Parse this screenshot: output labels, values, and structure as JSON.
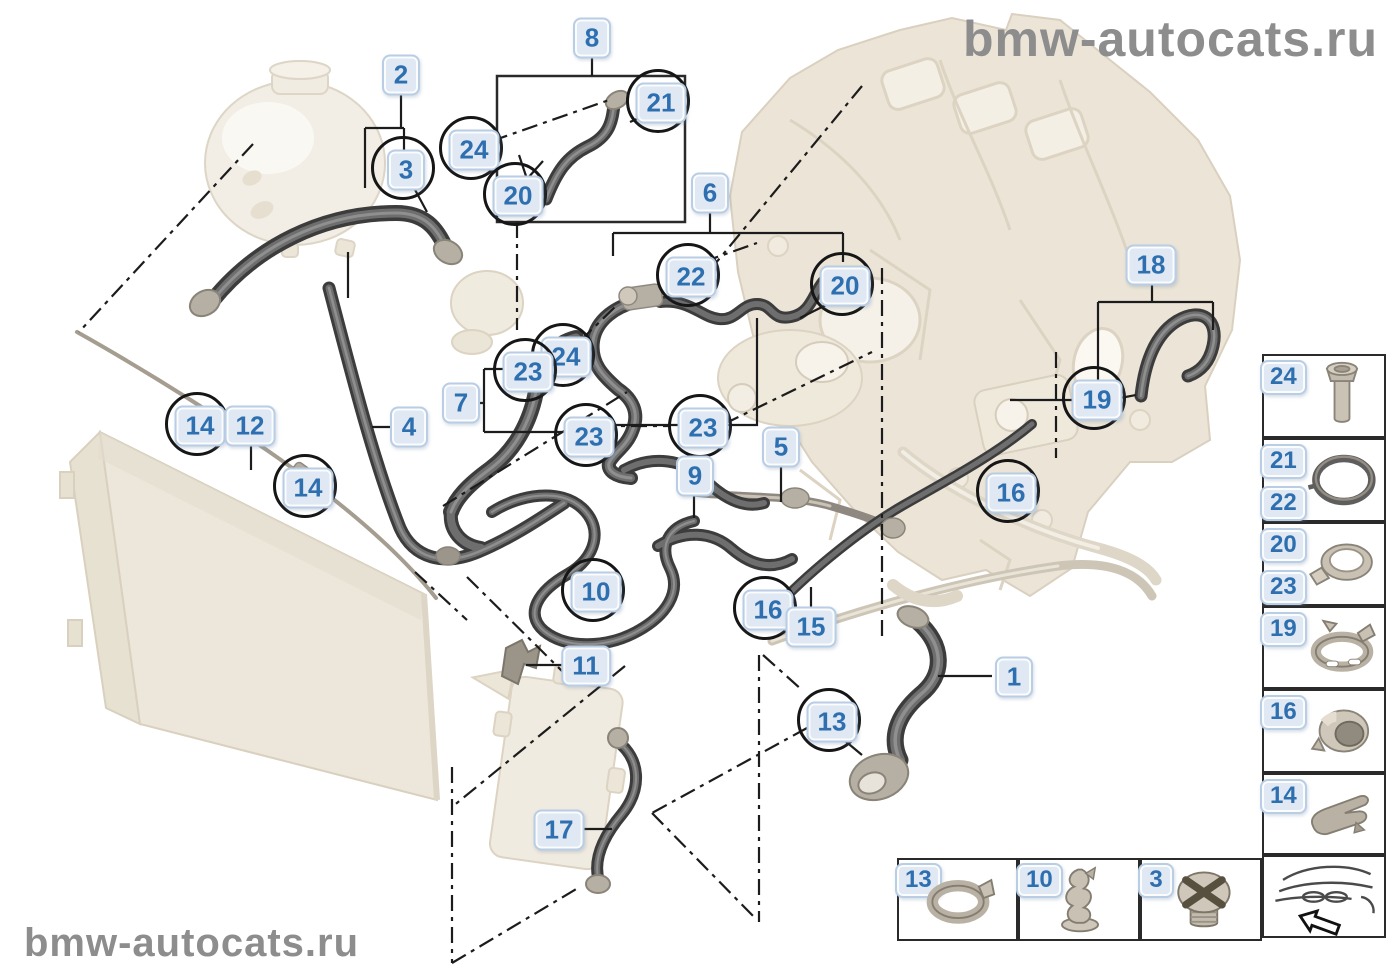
{
  "watermark": {
    "top_right": "bmw-autocats.ru",
    "bottom_left": "bmw-autocats.ru"
  },
  "colors": {
    "callout_text": "#2e6fb0",
    "callout_bg": "#dfe8f3",
    "callout_border": "#b9cde4",
    "circle_outline": "#161616",
    "hose_dark": "#3c3c3c",
    "part_pale": "#ece5d7",
    "watermark_gray": "#8d8d8d",
    "line_black": "#1c1c1c"
  },
  "callouts": [
    {
      "label": "2",
      "x": 401,
      "y": 75,
      "circled": false
    },
    {
      "label": "8",
      "x": 592,
      "y": 38,
      "circled": false
    },
    {
      "label": "21",
      "x": 661,
      "y": 103,
      "circled": true
    },
    {
      "label": "24",
      "x": 474,
      "y": 150,
      "circled": true
    },
    {
      "label": "3",
      "x": 406,
      "y": 170,
      "circled": true
    },
    {
      "label": "20",
      "x": 518,
      "y": 196,
      "circled": true
    },
    {
      "label": "6",
      "x": 710,
      "y": 193,
      "circled": false
    },
    {
      "label": "22",
      "x": 691,
      "y": 277,
      "circled": true
    },
    {
      "label": "20",
      "x": 845,
      "y": 286,
      "circled": true
    },
    {
      "label": "18",
      "x": 1151,
      "y": 265,
      "circled": false
    },
    {
      "label": "24",
      "x": 566,
      "y": 357,
      "circled": true
    },
    {
      "label": "23",
      "x": 528,
      "y": 372,
      "circled": true
    },
    {
      "label": "7",
      "x": 461,
      "y": 403,
      "circled": false
    },
    {
      "label": "23",
      "x": 589,
      "y": 437,
      "circled": true
    },
    {
      "label": "23",
      "x": 703,
      "y": 428,
      "circled": true
    },
    {
      "label": "19",
      "x": 1097,
      "y": 400,
      "circled": true
    },
    {
      "label": "14",
      "x": 200,
      "y": 426,
      "circled": true
    },
    {
      "label": "12",
      "x": 250,
      "y": 426,
      "circled": false
    },
    {
      "label": "4",
      "x": 409,
      "y": 427,
      "circled": false
    },
    {
      "label": "5",
      "x": 781,
      "y": 447,
      "circled": false
    },
    {
      "label": "9",
      "x": 695,
      "y": 476,
      "circled": false
    },
    {
      "label": "14",
      "x": 308,
      "y": 488,
      "circled": true
    },
    {
      "label": "16",
      "x": 1011,
      "y": 493,
      "circled": true
    },
    {
      "label": "10",
      "x": 596,
      "y": 592,
      "circled": true
    },
    {
      "label": "16",
      "x": 768,
      "y": 610,
      "circled": true
    },
    {
      "label": "15",
      "x": 811,
      "y": 627,
      "circled": false
    },
    {
      "label": "11",
      "x": 586,
      "y": 666,
      "circled": false
    },
    {
      "label": "1",
      "x": 1014,
      "y": 677,
      "circled": false
    },
    {
      "label": "13",
      "x": 832,
      "y": 722,
      "circled": true
    },
    {
      "label": "17",
      "x": 559,
      "y": 830,
      "circled": false
    }
  ],
  "sidebar": {
    "cells": [
      {
        "labels": [
          "24"
        ],
        "icon": "bolt-icon"
      },
      {
        "labels": [
          "21",
          "22"
        ],
        "icon": "o-ring-icon"
      },
      {
        "labels": [
          "20",
          "23"
        ],
        "icon": "hose-clamp-icon"
      },
      {
        "labels": [
          "19"
        ],
        "icon": "spring-band-clamp-icon"
      },
      {
        "labels": [
          "16"
        ],
        "icon": "plastic-collar-icon"
      },
      {
        "labels": [
          "14"
        ],
        "icon": "spring-clip-icon"
      },
      {
        "labels": [],
        "icon": "car-direction-icon"
      }
    ]
  },
  "bottom_legend": {
    "cells": [
      {
        "label": "13",
        "icon": "band-clamp-icon"
      },
      {
        "label": "10",
        "icon": "retaining-clip-icon"
      },
      {
        "label": "3",
        "icon": "phillips-screw-icon"
      }
    ]
  }
}
